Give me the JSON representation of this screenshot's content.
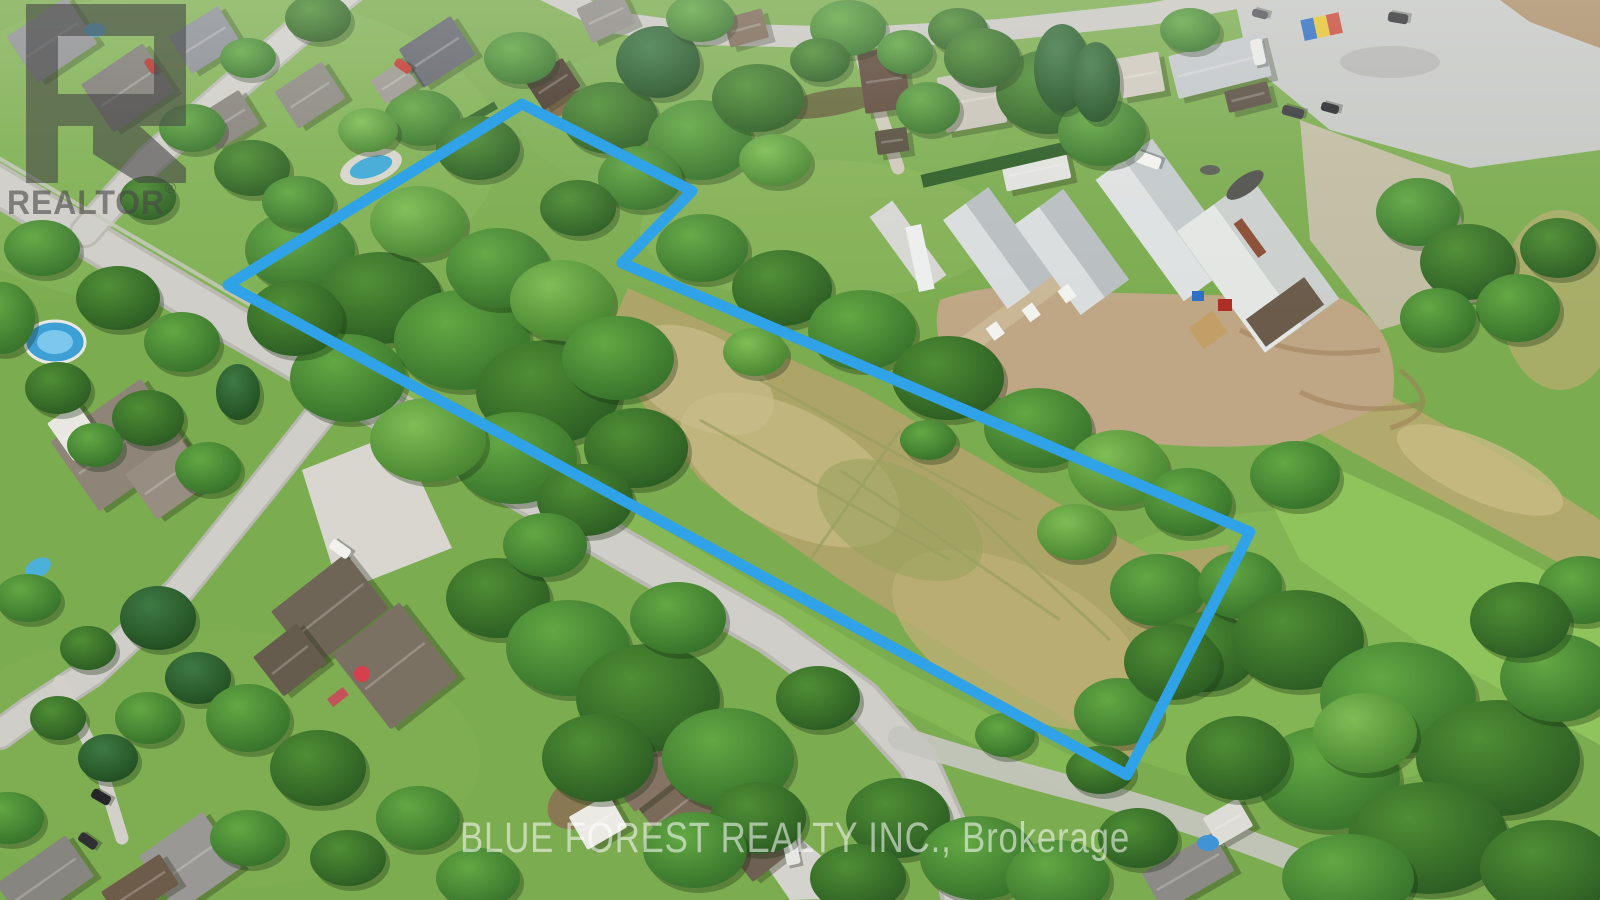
{
  "watermarks": {
    "realtor_logo": {
      "label": "REALTOR",
      "registered_mark": "®",
      "color": "#474747",
      "opacity": "0.6"
    },
    "brokerage_line": {
      "text": "BLUE FOREST REALTY INC., Brokerage",
      "color": "rgba(255,255,255,0.55)"
    }
  },
  "property_outline": {
    "points": "228,285 522,104 692,191 622,263 1250,532 1127,775",
    "color": "#2FA2E8",
    "stroke_width": "11"
  },
  "palette": {
    "grass": "#7CAC50",
    "meadow": "#ADA468",
    "road": "#CFCEC8",
    "dirt_yard": "#BFA785",
    "tree_dark": "#2A5A22",
    "tree_light": "#7FBE55"
  }
}
